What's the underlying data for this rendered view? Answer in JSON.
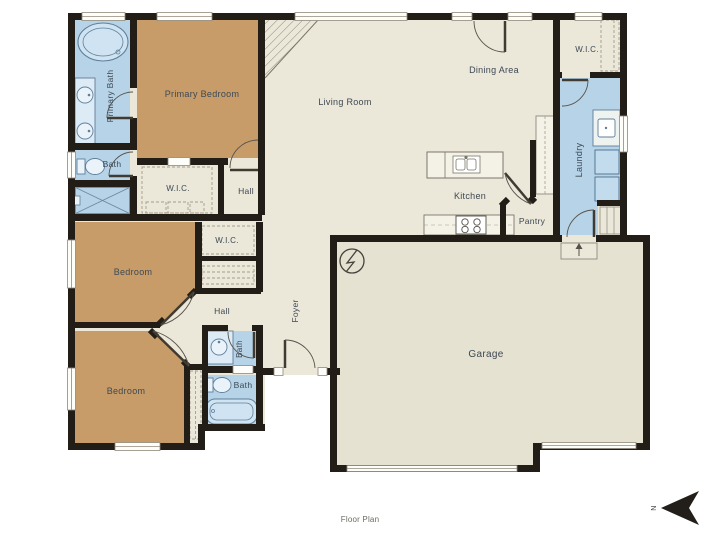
{
  "caption": "Floor Plan",
  "compass": {
    "label": "N"
  },
  "rooms": [
    {
      "id": "primary-bath",
      "label": "Primary Bath"
    },
    {
      "id": "bath-upper",
      "label": "Bath"
    },
    {
      "id": "primary-bedroom",
      "label": "Primary Bedroom"
    },
    {
      "id": "wic-primary",
      "label": "W.I.C."
    },
    {
      "id": "hall-upper",
      "label": "Hall"
    },
    {
      "id": "living-room",
      "label": "Living Room"
    },
    {
      "id": "dining-area",
      "label": "Dining Area"
    },
    {
      "id": "wic-entry",
      "label": "W.I.C."
    },
    {
      "id": "laundry",
      "label": "Laundry"
    },
    {
      "id": "kitchen",
      "label": "Kitchen"
    },
    {
      "id": "pantry",
      "label": "Pantry"
    },
    {
      "id": "bedroom-middle",
      "label": "Bedroom"
    },
    {
      "id": "wic-middle",
      "label": "W.I.C."
    },
    {
      "id": "hall-middle",
      "label": "Hall"
    },
    {
      "id": "bedroom-lower",
      "label": "Bedroom"
    },
    {
      "id": "bath-middle",
      "label": "Bath"
    },
    {
      "id": "bath-lower",
      "label": "Bath"
    },
    {
      "id": "foyer",
      "label": "Foyer"
    },
    {
      "id": "garage",
      "label": "Garage"
    }
  ],
  "colors": {
    "wall": "#221d16",
    "floor_beige": "#ebe7d9",
    "garage_floor": "#e6e2d2",
    "bedroom_tan": "#c89c69",
    "bath_blue": "#b6d3e7",
    "label_text": "#3d4854"
  }
}
